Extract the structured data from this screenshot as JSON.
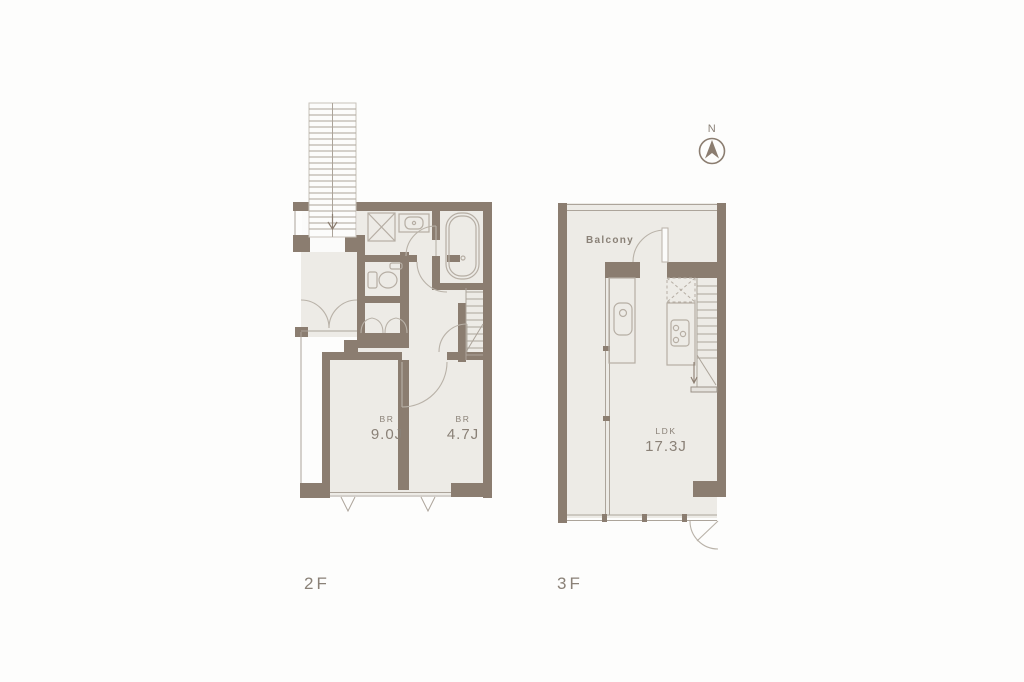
{
  "title": "Maisonette floor plan 2F / 3F",
  "colors": {
    "bg": "#fdfdfc",
    "floor": "#edebe6",
    "wall": "#8b7d70",
    "line": "#aca49a",
    "fixture": "#b6aea4",
    "text": "#8a8177"
  },
  "north": {
    "label": "N"
  },
  "floors": {
    "f2": {
      "label": "2F",
      "bedroom1": {
        "type": "BR",
        "area": "9.0J"
      },
      "bedroom2": {
        "type": "BR",
        "area": "4.7J"
      }
    },
    "f3": {
      "label": "3F",
      "balcony_label": "Balcony",
      "ldk": {
        "type": "LDK",
        "area": "17.3J"
      }
    }
  }
}
